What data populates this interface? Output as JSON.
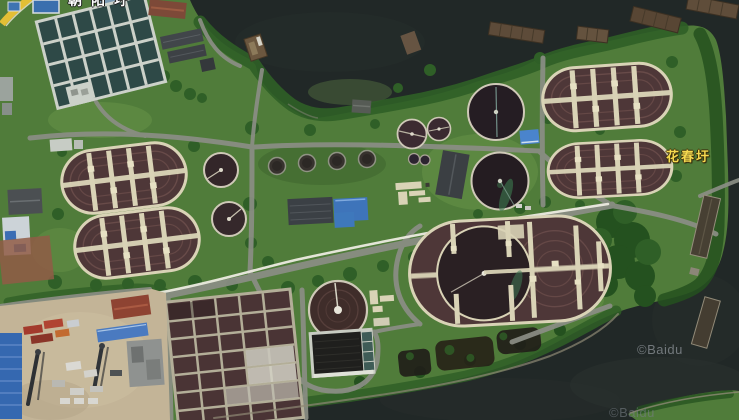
{
  "map": {
    "view": "satellite",
    "labels": {
      "place_right": {
        "text": "花春圩"
      },
      "place_top_clipped": {
        "text": "朝阳圩"
      }
    },
    "watermarks": {
      "primary": {
        "text": "©Baidu"
      },
      "secondary": {
        "text": "©Baidu"
      }
    },
    "palette": {
      "water": "#212827",
      "waterlight": "#2b3230",
      "land": "#507c3a",
      "grass": "#6f9a4e",
      "tree": "#2f5f27",
      "treedark": "#24511f",
      "road": "#8b8e85",
      "pipeline": "#ecebe0",
      "walkway": "#d9d3b6",
      "walkway2": "#e7e1c4",
      "ditchwater": "#4e3738",
      "ditchlane": "#6f504d",
      "clarifier": "#2c2127",
      "clarifierrim": "#cfc9b8",
      "gridframe": "#ccd1c9",
      "gridcell": "#2e4947",
      "aerframe": "#b3ae98",
      "aercell": "#4a3435",
      "yard": "#c3b497",
      "roofblue": "#3e74ba",
      "roofred": "#8e4332",
      "roofdark": "#41464a",
      "containerred": "#a33a2c",
      "barge": "#5d4b39",
      "sand": "#8f8975",
      "labelyellow": "#f5d94f",
      "yellowroad": "#e3bf35"
    }
  }
}
